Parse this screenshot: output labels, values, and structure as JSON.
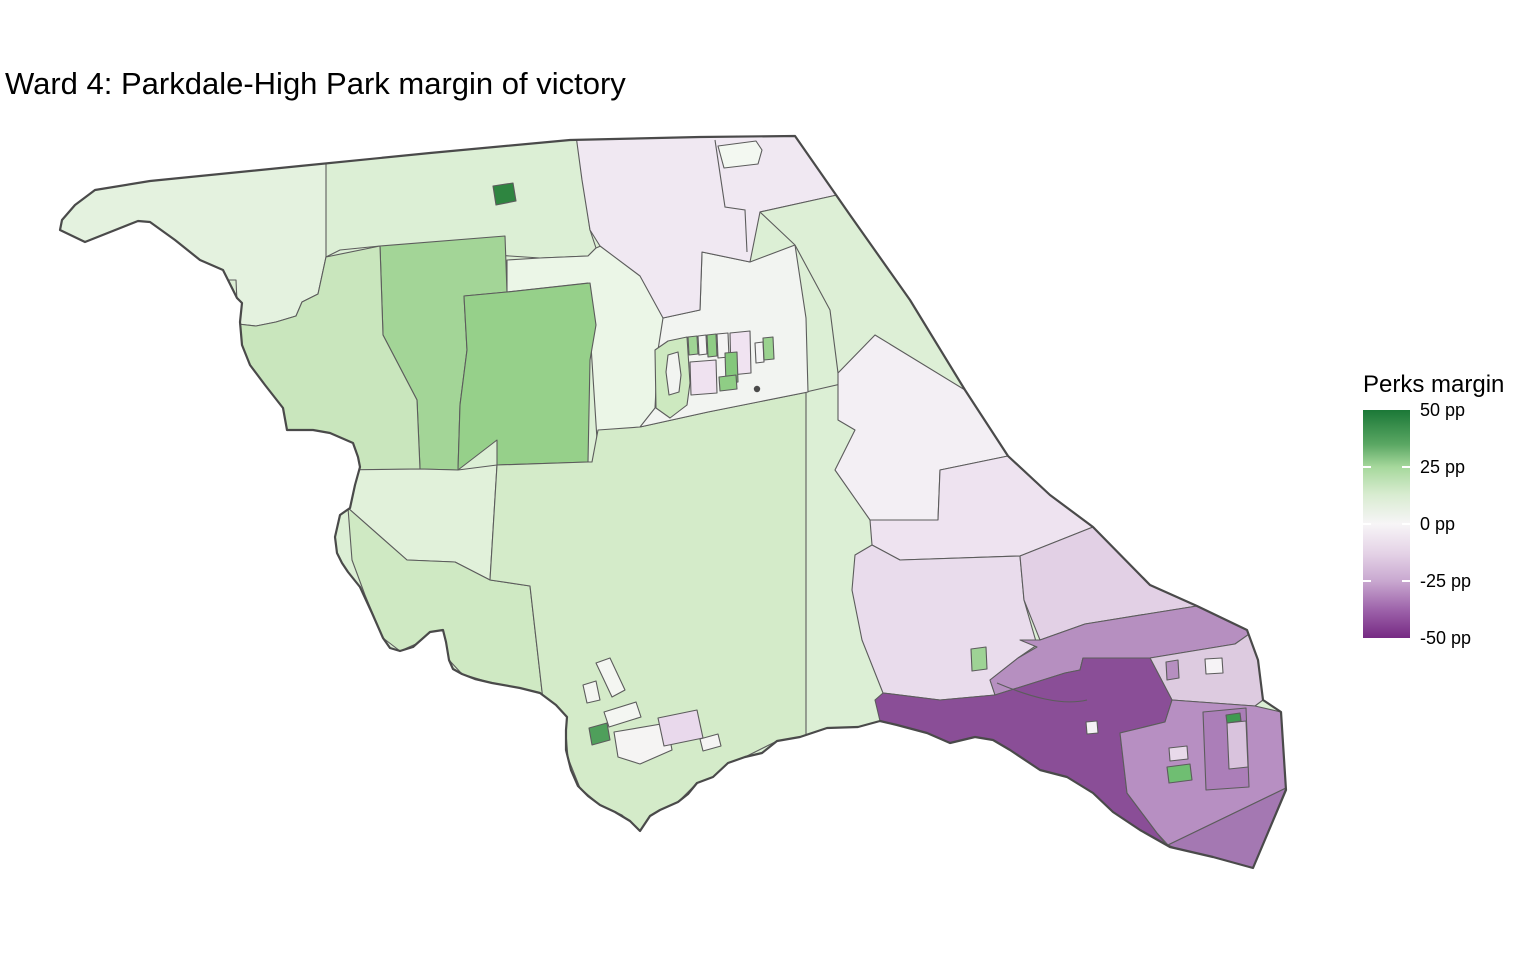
{
  "title": "Ward 4: Parkdale-High Park margin of victory",
  "legend": {
    "title": "Perks margin",
    "ticks": [
      "50 pp",
      "25 pp",
      "0 pp",
      "-25 pp",
      "-50 pp"
    ],
    "bar": {
      "top_px": 410,
      "height_px": 228,
      "width_px": 47,
      "left_px": 0
    },
    "gradient_stops": [
      {
        "pos": 0,
        "color": "#1b7837"
      },
      {
        "pos": 15,
        "color": "#5aa763"
      },
      {
        "pos": 25,
        "color": "#a6d89c"
      },
      {
        "pos": 37,
        "color": "#d8ecd0"
      },
      {
        "pos": 50,
        "color": "#f7f5f7"
      },
      {
        "pos": 63,
        "color": "#e4d2e6"
      },
      {
        "pos": 75,
        "color": "#c9a8d0"
      },
      {
        "pos": 88,
        "color": "#9c61a9"
      },
      {
        "pos": 100,
        "color": "#762a83"
      }
    ],
    "scale_meaning": {
      "variable": "Perks margin of victory, percentage points",
      "max_label": "50 pp",
      "min_label": "-50 pp",
      "positive_color": "#1b7837",
      "zero_color": "#f7f7f7",
      "negative_color": "#762a83"
    }
  },
  "map": {
    "border_color": "#5c5c5c",
    "outline_color": "#4a4a4a",
    "base_fill": "#dcefd5",
    "outline": "M62,220 L75,205 L95,190 L150,181 L300,166 L430,153 L570,140 L700,137 L795,136 L850,215 L910,300 L965,390 L1008,456 L1050,495 L1093,527 L1150,585 L1197,606 L1247,630 L1258,660 L1263,700 L1281,712 L1286,790 L1253,868 L1213,857 L1170,847 L1140,830 L1113,812 L1093,793 L1067,777 L1040,770 L1010,750 L993,740 L975,737 L950,743 L927,733 L897,725 L880,721 L858,727 L827,728 L800,737 L777,741 L762,753 L745,757 L728,763 L713,777 L697,783 L688,794 L678,802 L660,810 L650,816 L640,831 L630,821 L615,812 L600,805 L588,796 L578,786 L571,770 L566,750 L566,730 L567,717 L556,705 L540,693 L520,688 L492,683 L475,679 L462,674 L453,669 L449,660 L446,642 L443,630 L430,632 L413,647 L400,651 L390,648 L383,638 L372,613 L360,587 L348,572 L342,563 L337,553 L335,537 L340,515 L350,508 L355,485 L360,467 L358,457 L353,443 L330,433 L313,430 L287,430 L283,408 L265,385 L250,365 L242,345 L240,322 L242,303 L237,298 L223,270 L200,260 L175,240 L150,222 L138,221 L85,242 L60,230 Z",
    "regions": [
      {
        "name": "poll-nw-strip",
        "fill": "#e4f2df",
        "points": "30,120 330,130 326,257 318,294 302,302 296,316 276,322 256,326 238,324 236,280 30,280"
      },
      {
        "name": "poll-north-2",
        "fill": "#dcefd5",
        "points": "326,130 578,124 583,180 590,230 596,248 588,256 540,258 420,250 380,246 340,250 326,257"
      },
      {
        "name": "poll-pale-mid",
        "fill": "#ebf6e7",
        "points": "507,260 540,258 588,256 596,248 603,245 622,237 652,232 665,322 668,455 598,455 590,330 588,283 507,292"
      },
      {
        "name": "poll-junction-block-west",
        "fill": "#a3d597",
        "points": "380,246 505,236 507,292 464,296 467,350 460,405 458,470 420,469 417,400 383,335"
      },
      {
        "name": "poll-junction-block-east",
        "fill": "#96d08a",
        "points": "507,292 590,283 596,325 590,360 588,462 497,465 497,440 458,470 460,405 467,350 464,296"
      },
      {
        "name": "poll-tiny-green",
        "fill": "#2e8540",
        "points": "493,186 513,183 516,201 496,205"
      },
      {
        "name": "poll-west-wing",
        "fill": "#c9e6bd",
        "points": "238,324 256,326 276,322 296,316 302,302 318,294 326,257 380,246 383,335 417,400 420,469 360,470 356,450 330,434 287,432 283,408 265,385 250,365 242,345"
      },
      {
        "name": "poll-swansea-north",
        "fill": "#e1f1da",
        "points": "335,470 420,469 458,470 497,465 490,580 455,562 407,560 348,508 337,488"
      },
      {
        "name": "poll-swansea-south",
        "fill": "#cfe9c3",
        "points": "348,508 407,560 455,562 490,580 530,586 543,700 520,688 492,683 462,674 449,660 446,642 443,630 425,640 400,651 383,638 365,595 352,560"
      },
      {
        "name": "poll-high-park",
        "fill": "#d4ebc9",
        "points": "592,462 598,430 640,427 708,412 808,392 810,430 806,737 777,741 745,757 713,777 697,783 678,802 660,810 640,831 622,815 600,805 580,788 568,758 565,720 543,700 530,586 490,580 497,465 588,462"
      },
      {
        "name": "poll-roncesvalles-west",
        "fill": "#dcefd5",
        "points": "806,392 880,375 900,460 902,560 880,721 858,727 827,728 806,737"
      },
      {
        "name": "poll-junction-white",
        "fill": "#f2f4f1",
        "points": "663,318 700,310 702,252 750,262 795,245 806,318 808,392 708,412 640,427 655,408 658,350"
      },
      {
        "name": "poll-pink-top",
        "fill": "#f0e8f2",
        "points": "575,128 800,131 845,205 837,195 760,212 750,262 702,252 700,310 663,318 640,276 600,246 590,230 582,180"
      },
      {
        "name": "poll-white-blob",
        "fill": "#f3f8f1",
        "points": "718,146 756,141 762,150 758,164 724,168"
      },
      {
        "name": "poll-green-diagonal",
        "fill": "#ddefd6",
        "points": "760,212 837,195 845,205 910,300 965,390 1008,456 940,470 880,455 838,373 830,310 795,245"
      },
      {
        "name": "poll-nearwhite-east",
        "fill": "#f3eff4",
        "points": "838,373 875,335 965,390 1008,456 940,470 938,520 870,520 835,470 855,430 838,420"
      },
      {
        "name": "poll-pink-band-1",
        "fill": "#eee3f0",
        "points": "870,520 938,520 940,470 1008,456 1050,495 1093,527 1020,556 900,560 872,545"
      },
      {
        "name": "poll-pink-band-2",
        "fill": "#e9dcec",
        "points": "855,555 872,545 900,560 1020,556 1024,600 1037,645 1018,658 990,680 995,695 940,700 883,693 862,640 852,590"
      },
      {
        "name": "poll-pink-band-3",
        "fill": "#e2d0e5",
        "points": "1020,556 1093,527 1150,585 1197,606 1147,614 1085,624 1040,640 1024,600"
      },
      {
        "name": "poll-purple-band",
        "fill": "#b68fc0",
        "points": "1040,640 1085,624 1147,614 1197,606 1252,632 1235,644 1150,658 1083,658 1080,670 1065,673 995,695 990,680 1018,658 1037,647 1020,640"
      },
      {
        "name": "poll-pink-east",
        "fill": "#ddcbe0",
        "points": "1252,632 1258,660 1263,700 1255,706 1172,700 1150,658 1235,644"
      },
      {
        "name": "poll-parkdale-dark",
        "fill": "#8a4e97",
        "points": "875,700 883,693 940,700 995,695 1065,673 1080,670 1083,658 1150,658 1172,700 1165,722 1120,733 1127,793 1157,833 1168,847 1150,838 1113,812 1093,793 1067,777 1040,770 1010,750 993,740 975,737 950,743 927,733 897,725 880,721"
      },
      {
        "name": "poll-se-mid",
        "fill": "#b78fc2",
        "points": "1165,722 1172,700 1255,706 1281,712 1286,788 1168,845 1157,833 1127,793 1120,733"
      },
      {
        "name": "poll-se-tip",
        "fill": "#a478b2",
        "points": "1168,845 1286,788 1253,868 1213,857 1180,850"
      },
      {
        "name": "poll-green-dot",
        "fill": "#9ed395",
        "points": "971,649 986,647 987,669 972,671"
      },
      {
        "name": "poll-white-dot",
        "fill": "#f4f1f4",
        "points": "1086,722 1097,721 1098,733 1087,734"
      },
      {
        "name": "poll-white-square",
        "fill": "#f6f3f6",
        "points": "1205,659 1222,658 1223,673 1206,674"
      },
      {
        "name": "poll-purple-chip",
        "fill": "#b68fc0",
        "points": "1166,662 1178,660 1179,678 1167,680"
      },
      {
        "name": "bldg-outer",
        "fill": "#ab7eb8",
        "points": "1203,712 1246,708 1249,787 1206,790"
      },
      {
        "name": "bldg-inner",
        "fill": "#d9c3dd",
        "points": "1227,723 1246,721 1248,767 1229,769"
      },
      {
        "name": "bldg-green-sliver",
        "fill": "#3f9a52",
        "points": "1226,715 1240,713 1241,721 1227,723"
      },
      {
        "name": "chip-pink",
        "fill": "#e8daea",
        "points": "1169,748 1187,746 1188,759 1170,761"
      },
      {
        "name": "chip-green",
        "fill": "#6fbe72",
        "points": "1167,767 1190,764 1192,780 1169,783"
      },
      {
        "name": "hp-white-1",
        "fill": "#f4f6f2",
        "points": "596,663 610,658 625,690 612,697"
      },
      {
        "name": "hp-white-2",
        "fill": "#f4f6f2",
        "points": "583,685 596,681 600,700 587,703"
      },
      {
        "name": "hp-white-3",
        "fill": "#f4f6f2",
        "points": "604,712 636,702 641,717 609,727"
      },
      {
        "name": "hp-green-dark",
        "fill": "#4f9f5b",
        "points": "589,728 607,723 610,740 592,745"
      },
      {
        "name": "hp-white-4",
        "fill": "#f5f4f3",
        "points": "614,732 667,723 672,750 640,764 618,757"
      },
      {
        "name": "hp-pink",
        "fill": "#e9d9ec",
        "points": "658,718 697,710 703,738 664,746"
      },
      {
        "name": "hp-white-5",
        "fill": "#f5f4f3",
        "points": "700,739 718,734 721,746 703,751"
      },
      {
        "name": "ctr-green-blob",
        "fill": "#cde9c0",
        "points": "655,350 668,341 687,337 690,383 687,405 670,418 656,408"
      },
      {
        "name": "ctr-hole",
        "fill": "#f2f4f1",
        "points": "668,355 678,352 681,375 679,392 669,395 666,372"
      },
      {
        "name": "ctr-g1",
        "fill": "#a0d495",
        "points": "688,337 697,336 698,354 689,355"
      },
      {
        "name": "ctr-w1",
        "fill": "#f4f4f4",
        "points": "698,336 706,335 707,354 699,355"
      },
      {
        "name": "ctr-g2",
        "fill": "#8fcd85",
        "points": "707,335 716,334 717,356 708,357"
      },
      {
        "name": "ctr-w2",
        "fill": "#f4f4f4",
        "points": "717,334 728,333 729,357 718,358"
      },
      {
        "name": "ctr-pink",
        "fill": "#f0e3f1",
        "points": "730,333 750,331 751,373 731,375"
      },
      {
        "name": "ctr-greenbar",
        "fill": "#84c77c",
        "points": "725,353 737,352 738,382 726,384"
      },
      {
        "name": "ctr-pale",
        "fill": "#efe2f0",
        "points": "690,362 716,360 717,393 691,395"
      },
      {
        "name": "ctr-g3",
        "fill": "#8fcd85",
        "points": "719,377 736,375 737,389 720,391"
      },
      {
        "name": "ctr-w3",
        "fill": "#f4f4f4",
        "points": "755,343 763,342 764,362 756,363"
      },
      {
        "name": "ctr-g4",
        "fill": "#9ad28f",
        "points": "763,338 773,337 774,359 764,360"
      }
    ],
    "circles": [
      {
        "name": "map-point-dot",
        "cx": 757,
        "cy": 389,
        "r": 3.2,
        "fill": "#4a4a4a"
      }
    ],
    "lines": [
      {
        "name": "pink-divider",
        "d": "M715,140 L725,207 L745,210 L747,252"
      },
      {
        "name": "parkdale-divider",
        "d": "M997,683 C1030,697 1062,706 1087,700"
      }
    ]
  }
}
